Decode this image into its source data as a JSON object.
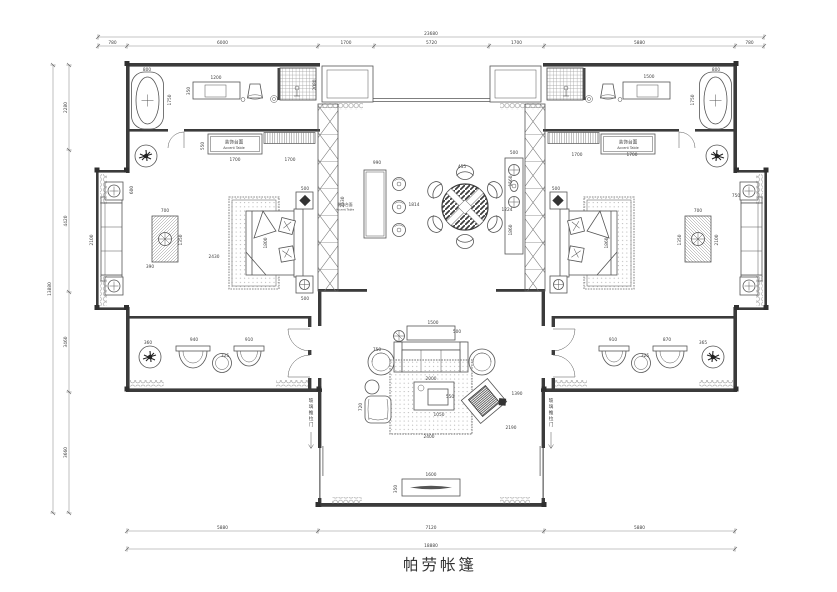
{
  "title": "帕劳帐篷",
  "colors": {
    "wall": "#3b3b3b",
    "line": "#555555",
    "dim": "#3d3d3d",
    "hatch": "#8a8a8a",
    "title": "#333333"
  },
  "labels": [
    {
      "t": "装饰台面",
      "x": 234,
      "y": 143.5,
      "s": 4.6
    },
    {
      "t": "Accent Table",
      "x": 234,
      "y": 149,
      "s": 3.4
    },
    {
      "t": "装饰台面",
      "x": 628,
      "y": 143.5,
      "s": 4.6
    },
    {
      "t": "Accent Table",
      "x": 628,
      "y": 149,
      "s": 3.4
    },
    {
      "t": "装饰台面",
      "x": 345,
      "y": 206,
      "s": 3.8
    },
    {
      "t": "Accent Table",
      "x": 345,
      "y": 210.5,
      "s": 2.9
    },
    {
      "t": "玻璃推拉门",
      "x": 311,
      "y": 402,
      "s": 4.6,
      "v": true
    },
    {
      "t": "玻璃推拉门",
      "x": 551,
      "y": 402,
      "s": 4.6,
      "v": true
    }
  ],
  "dim_chains": [
    {
      "o": "h",
      "p": 37,
      "ticks": [
        98,
        764
      ],
      "vals": [
        "23680"
      ]
    },
    {
      "o": "h",
      "p": 46,
      "ticks": [
        98,
        127,
        318,
        374,
        489,
        544,
        735,
        764
      ],
      "vals": [
        "780",
        "6000",
        "1700",
        "5720",
        "1700",
        "5880",
        "780"
      ]
    },
    {
      "o": "v",
      "p": 53,
      "ticks": [
        65,
        513
      ],
      "vals": [
        "13880"
      ]
    },
    {
      "o": "v",
      "p": 69,
      "ticks": [
        65,
        150,
        292,
        392,
        513
      ],
      "vals": [
        "2280",
        "4420",
        "3460",
        "3660"
      ]
    },
    {
      "o": "h",
      "p": 531,
      "ticks": [
        127,
        318,
        544,
        735
      ],
      "vals": [
        "5880",
        "7120",
        "5880"
      ]
    },
    {
      "o": "h",
      "p": 549,
      "ticks": [
        127,
        735
      ],
      "vals": [
        "18880"
      ]
    }
  ],
  "dims": [
    [
      "800",
      147,
      71
    ],
    [
      "1750",
      171,
      100,
      1
    ],
    [
      "1200",
      216,
      79
    ],
    [
      "350",
      190,
      91,
      1
    ],
    [
      "2080",
      316,
      85,
      1
    ],
    [
      "550",
      204,
      146,
      1
    ],
    [
      "1700",
      235,
      161
    ],
    [
      "1700",
      290,
      161
    ],
    [
      "500",
      305,
      190
    ],
    [
      "500",
      305,
      300
    ],
    [
      "2430",
      214,
      258
    ],
    [
      "1800",
      267,
      243,
      1
    ],
    [
      "2100",
      93,
      240,
      1
    ],
    [
      "600",
      133,
      190,
      1
    ],
    [
      "700",
      165,
      212
    ],
    [
      "1350",
      182,
      240,
      1
    ],
    [
      "390",
      150,
      268
    ],
    [
      "2530",
      344,
      202,
      1
    ],
    [
      "990",
      377,
      164
    ],
    [
      "1814",
      414,
      206
    ],
    [
      "455",
      462,
      168
    ],
    [
      "1224",
      507,
      211
    ],
    [
      "1560",
      512,
      181,
      1
    ],
    [
      "1860",
      512,
      230,
      1
    ],
    [
      "500",
      514,
      154
    ],
    [
      "1860",
      608,
      243,
      1
    ],
    [
      "500",
      556,
      190
    ],
    [
      "1500",
      649,
      78
    ],
    [
      "800",
      716,
      71
    ],
    [
      "1750",
      694,
      100,
      1
    ],
    [
      "1700",
      577,
      156
    ],
    [
      "1700",
      632,
      156
    ],
    [
      "700",
      698,
      212
    ],
    [
      "1350",
      681,
      240,
      1
    ],
    [
      "2100",
      718,
      240,
      1
    ],
    [
      "750",
      736,
      197
    ],
    [
      "360",
      148,
      344
    ],
    [
      "940",
      194,
      341
    ],
    [
      "325",
      225,
      357
    ],
    [
      "910",
      249,
      341
    ],
    [
      "910",
      613,
      341
    ],
    [
      "325",
      645,
      357
    ],
    [
      "870",
      667,
      341
    ],
    [
      "365",
      703,
      344
    ],
    [
      "1500",
      433,
      324
    ],
    [
      "500",
      457,
      333
    ],
    [
      "750",
      377,
      351
    ],
    [
      "2000",
      431,
      380
    ],
    [
      "550",
      450,
      398
    ],
    [
      "1050",
      439,
      416
    ],
    [
      "720",
      362,
      407,
      1
    ],
    [
      "2400",
      429,
      438
    ],
    [
      "1390",
      517,
      395
    ],
    [
      "2190",
      511,
      429
    ],
    [
      "1600",
      431,
      476
    ],
    [
      "350",
      397,
      489,
      1
    ]
  ]
}
